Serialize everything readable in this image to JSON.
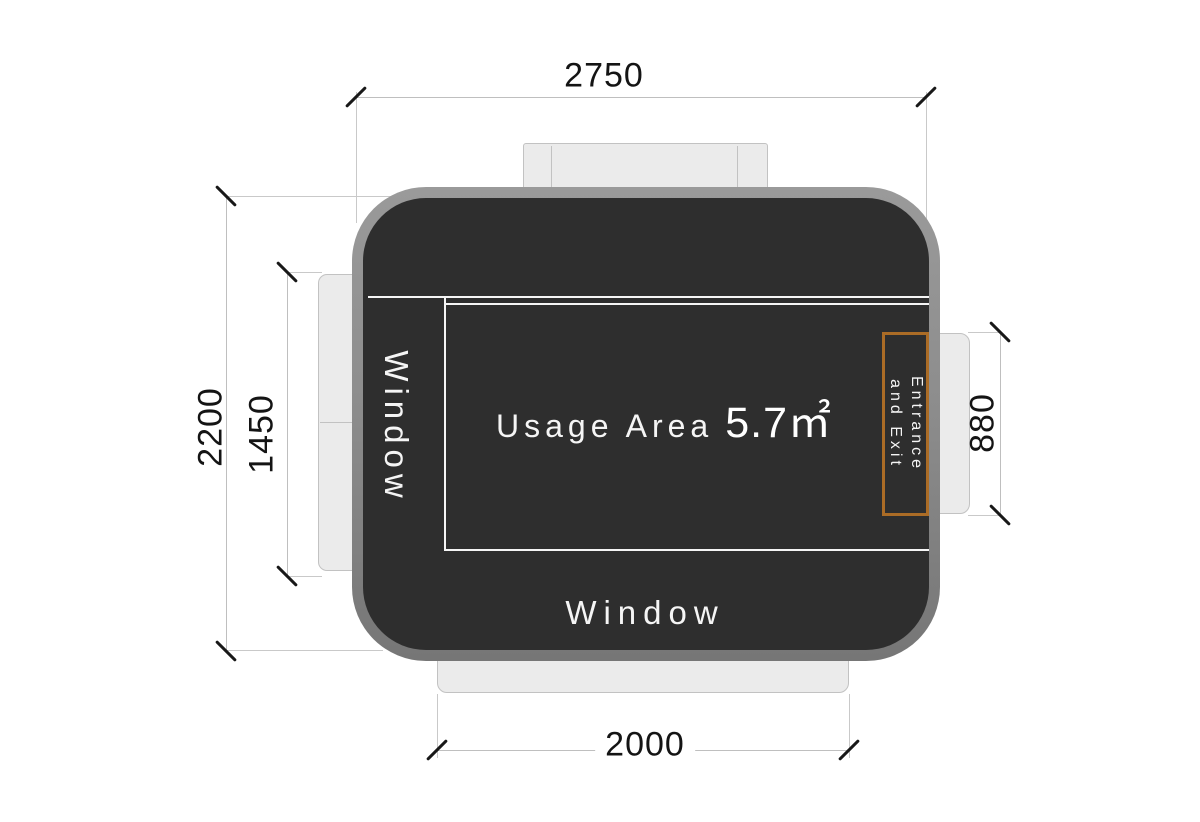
{
  "labels": {
    "usage_area": "Usage Area",
    "usage_value": "5.7㎡",
    "window_left": "Window",
    "window_bottom": "Window",
    "entrance_line1": "Entrance",
    "entrance_line2": "and Exit"
  },
  "dimensions": {
    "overall_width": "2750",
    "overall_height": "2200",
    "window_left_height": "1450",
    "door_height": "880",
    "window_bottom_width": "2000"
  },
  "colors": {
    "wall-gray": "#8d8d8d",
    "wall-gray-light": "#9a9a9a",
    "wall-gray-dark": "#767676",
    "room-dark": "#2e2e2e",
    "sill-gray": "#ebebeb",
    "sill-border": "#c2c2c2",
    "line-gray": "#c9c9c9",
    "dimline-gray": "#bfbfbf",
    "tick-black": "#181818",
    "accent-orange": "#ab6c26",
    "label-white": "#f5f5f5",
    "dim-text": "#141414"
  }
}
